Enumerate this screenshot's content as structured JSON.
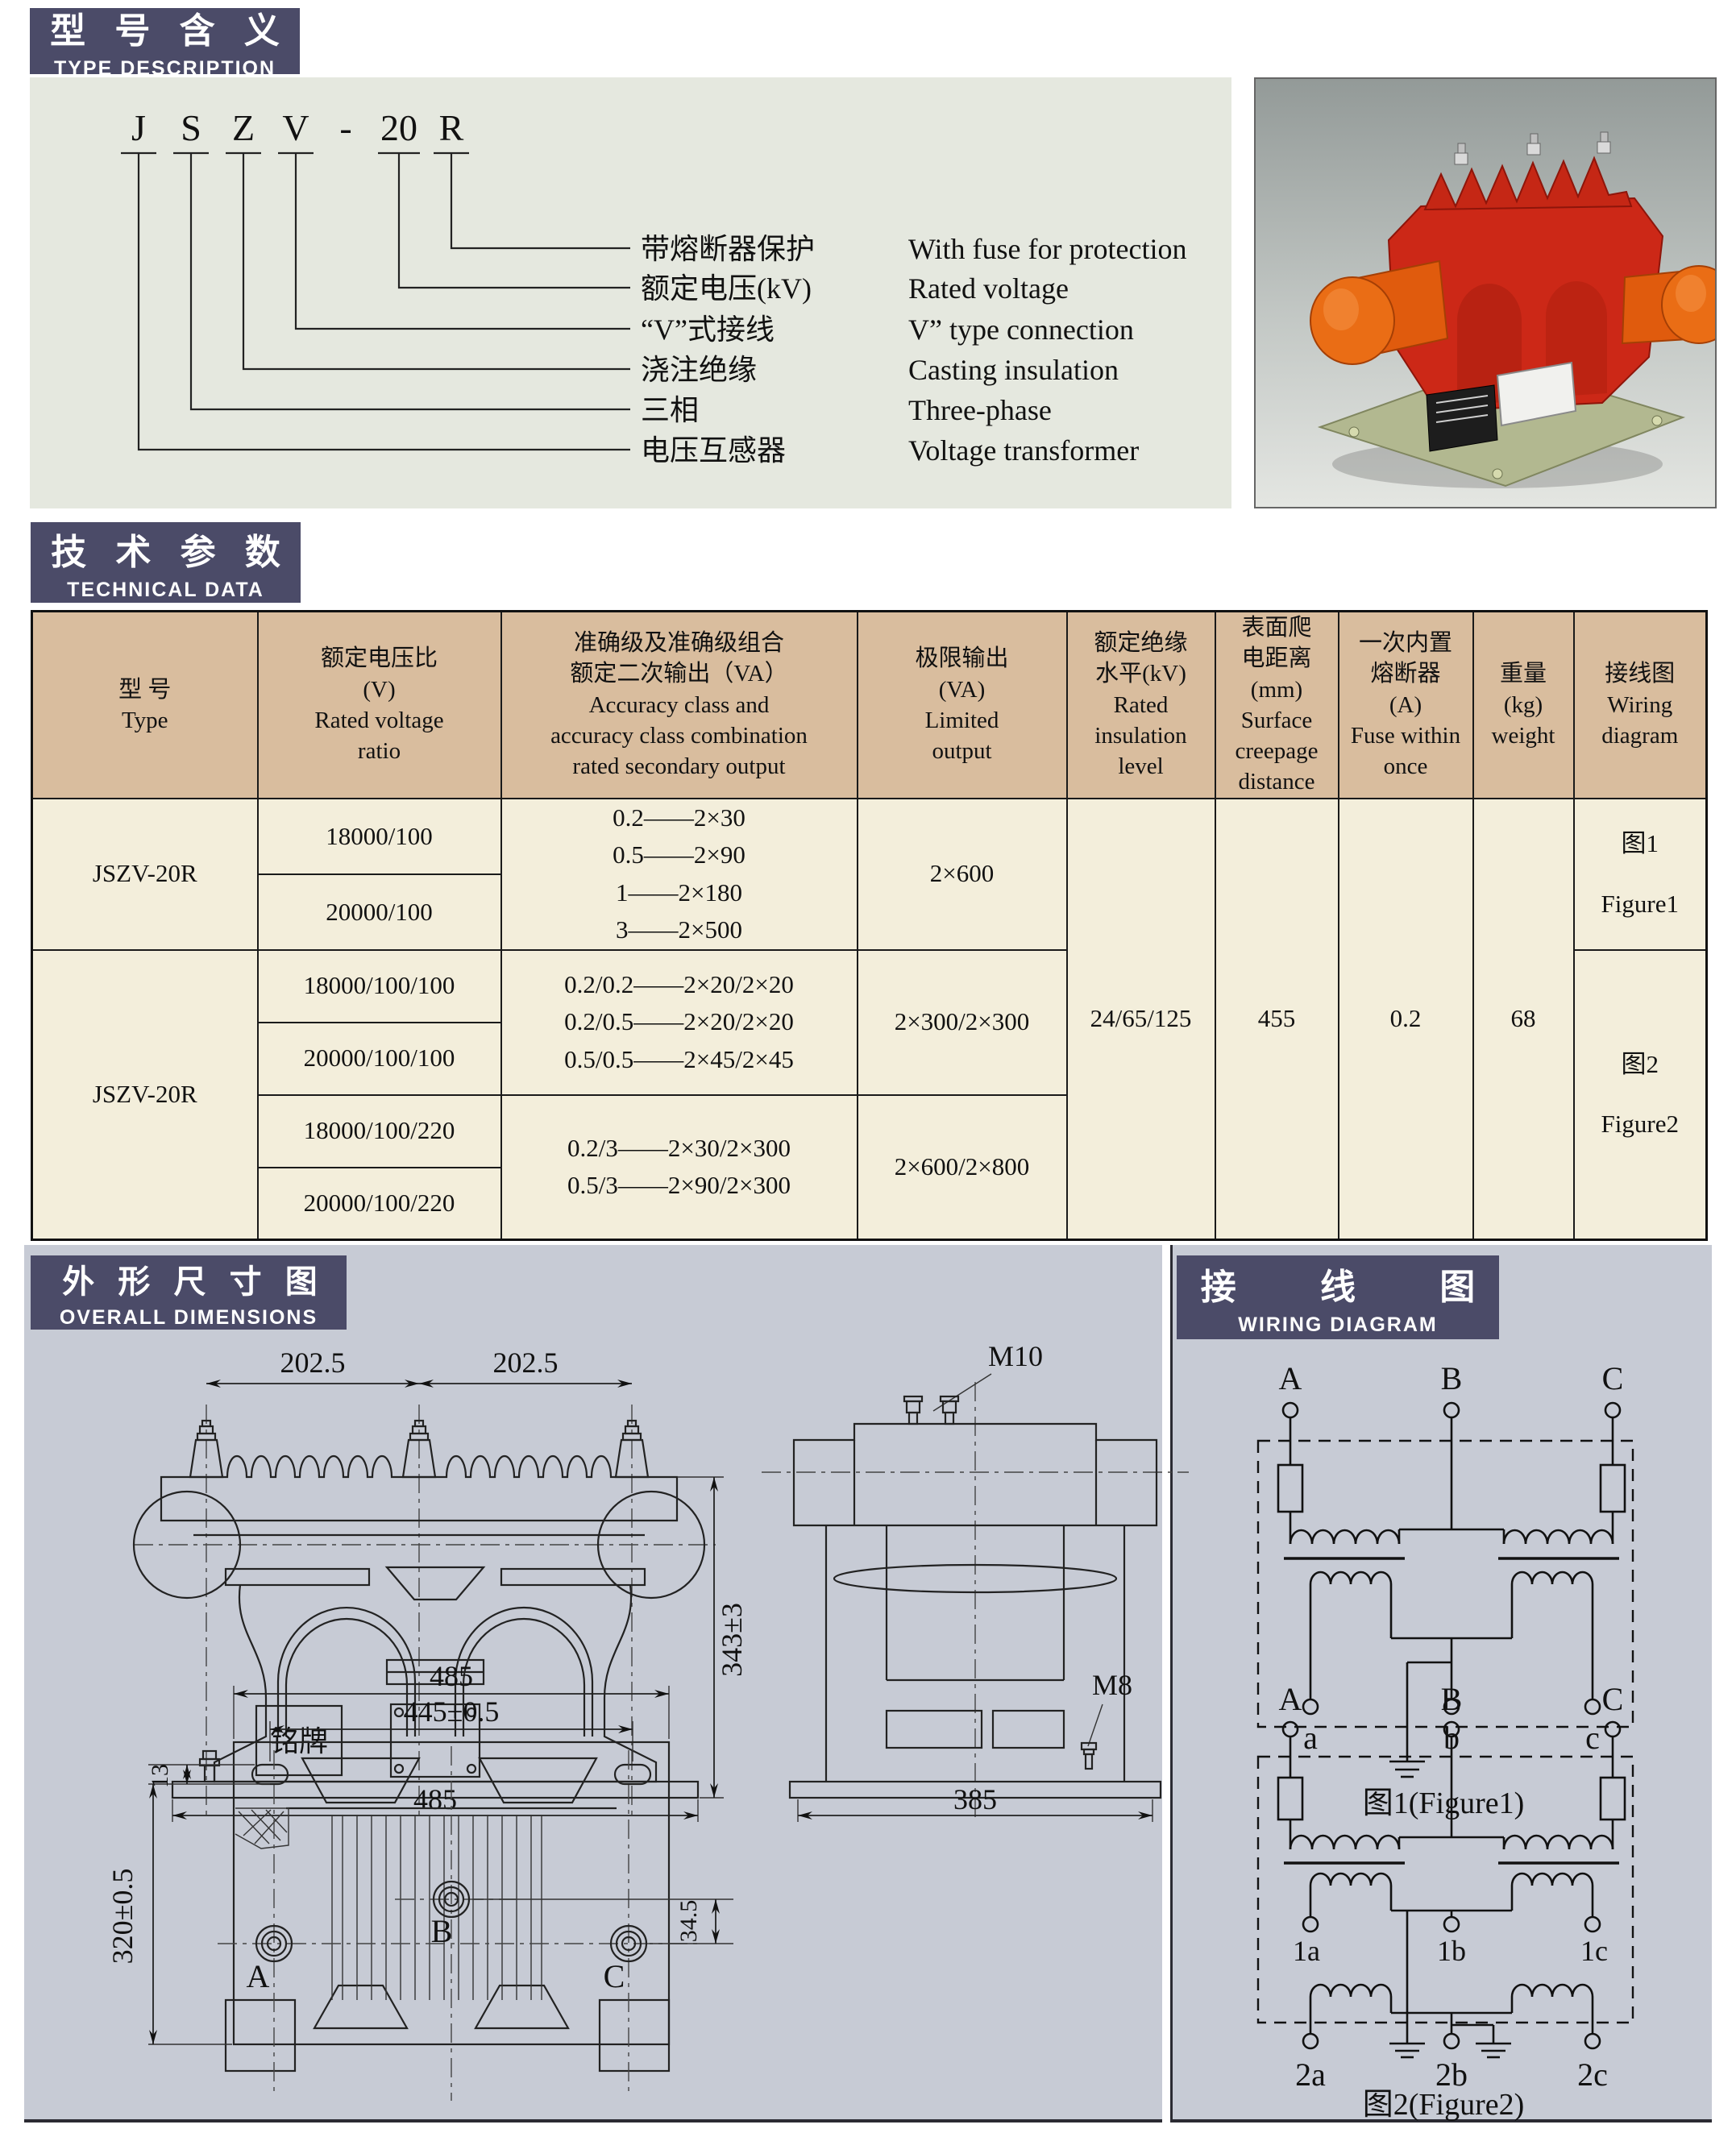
{
  "colors": {
    "section_header_bg": "#4b4b68",
    "section_header_text": "#ffffff",
    "type_box_bg": "#e5e8df",
    "table_header_bg": "#d9bd9e",
    "table_body_bg": "#f3eedb",
    "table_border": "#1a1a1a",
    "bottom_panel_bg": "#c7cbd5",
    "product_red": "#cc2817",
    "product_orange": "#e5650f",
    "product_base_green": "#b2b890"
  },
  "type_description": {
    "title_zh": "型 号 含 义",
    "title_en": "TYPE DESCRIPTION",
    "code_chars": [
      "J",
      "S",
      "Z",
      "V",
      "-",
      "20",
      "R"
    ],
    "labels": [
      {
        "zh": "带熔断器保护",
        "en": "With fuse for protection"
      },
      {
        "zh": "额定电压(kV)",
        "en": "Rated voltage"
      },
      {
        "zh": "“V”式接线",
        "en": "V” type connection"
      },
      {
        "zh": "浇注绝缘",
        "en": "Casting insulation"
      },
      {
        "zh": "三相",
        "en": "Three-phase"
      },
      {
        "zh": "电压互感器",
        "en": "Voltage transformer"
      }
    ]
  },
  "technical_data": {
    "title_zh": "技 术 参 数",
    "title_en": "TECHNICAL DATA",
    "columns": [
      "型  号\nType",
      "额定电压比\n(V)\nRated voltage\nratio",
      "准确级及准确级组合\n额定二次输出（VA）\nAccuracy class and\naccuracy class combination\nrated secondary output",
      "极限输出\n(VA)\nLimited\noutput",
      "额定绝缘\n水平(kV)\nRated\ninsulation\nlevel",
      "表面爬\n电距离\n(mm)\nSurface\ncreepage\ndistance",
      "一次内置\n熔断器\n(A)\nFuse within\nonce",
      "重量\n(kg)\nweight",
      "接线图\nWiring\ndiagram"
    ],
    "type_1": "JSZV-20R",
    "type_2": "JSZV-20R",
    "ratios": [
      "18000/100",
      "20000/100",
      "18000/100/100",
      "20000/100/100",
      "18000/100/220",
      "20000/100/220"
    ],
    "accuracy_1": "0.2——2×30\n0.5——2×90\n1——2×180\n3——2×500",
    "accuracy_2": "0.2/0.2——2×20/2×20\n0.2/0.5——2×20/2×20\n0.5/0.5——2×45/2×45",
    "accuracy_3": "0.2/3——2×30/2×300\n0.5/3——2×90/2×300",
    "output_1": "2×600",
    "output_2": "2×300/2×300",
    "output_3": "2×600/2×800",
    "insulation_level": "24/65/125",
    "creepage_distance": "455",
    "fuse_current": "0.2",
    "weight": "68",
    "wiring_1": "图1\nFigure1",
    "wiring_2": "图2\nFigure2"
  },
  "dimensions": {
    "title_zh": "外 形 尺 寸 图",
    "title_en": "OVERALL DIMENSIONS",
    "front_view": {
      "dim_top_left": "202.5",
      "dim_top_right": "202.5",
      "dim_height": "343±3",
      "dim_width": "485",
      "nameplate": "铭牌"
    },
    "side_view": {
      "thread_top": "M10",
      "thread_bottom": "M8",
      "dim_width": "385"
    },
    "bottom_view": {
      "dim_overall": "485",
      "dim_holes": "445±0.5",
      "dim_slot": "13",
      "dim_depth": "320±0.5",
      "dim_offset": "34.5",
      "hole_a": "A",
      "hole_b": "B",
      "hole_c": "C"
    }
  },
  "wiring_diagrams": {
    "title_zh": "接 线 图",
    "title_en": "WIRING DIAGRAM",
    "figure_1": {
      "terminals_top": [
        "A",
        "B",
        "C"
      ],
      "terminals_bottom": [
        "a",
        "b",
        "c"
      ],
      "caption": "图1(Figure1)"
    },
    "figure_2": {
      "terminals_top": [
        "A",
        "B",
        "C"
      ],
      "terminals_mid": [
        "1a",
        "1b",
        "1c"
      ],
      "terminals_bottom": [
        "2a",
        "2b",
        "2c"
      ],
      "caption": "图2(Figure2)"
    }
  }
}
